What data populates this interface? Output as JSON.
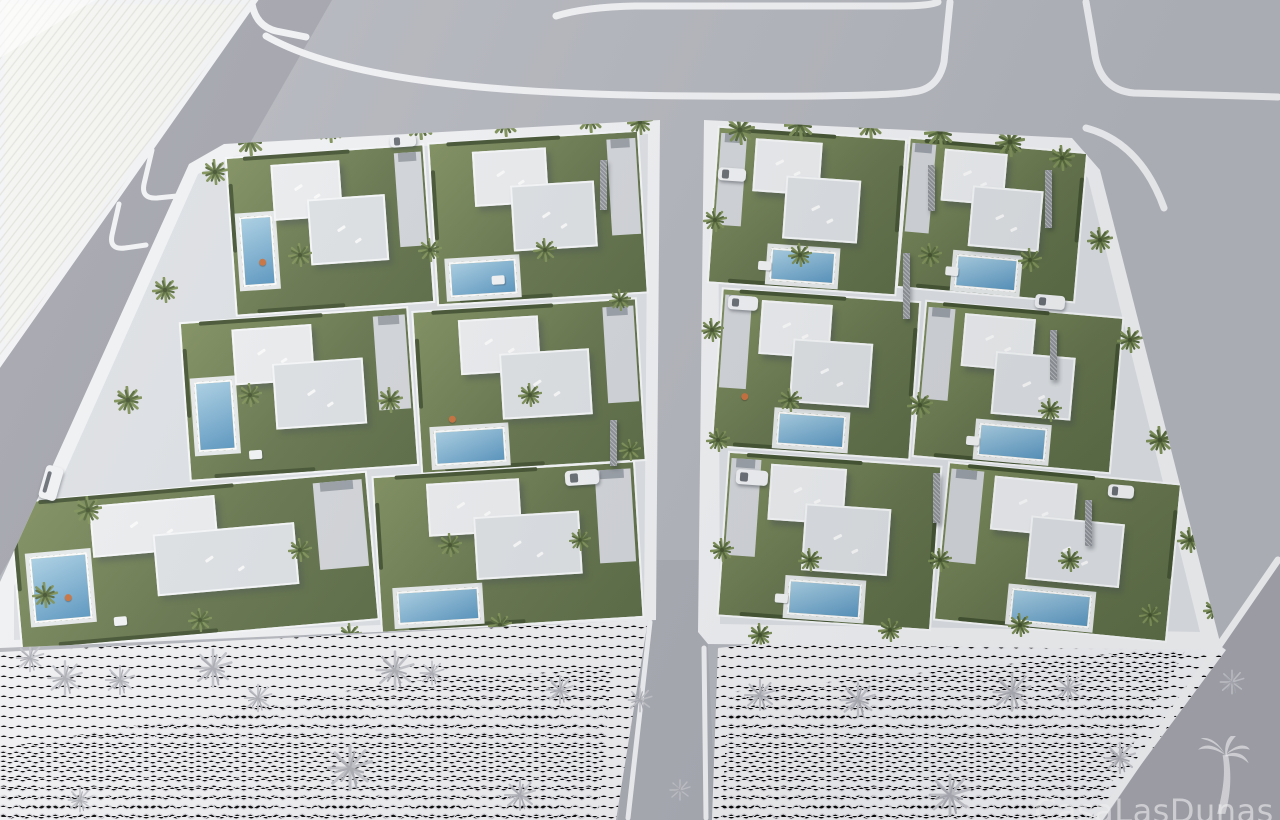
{
  "watermark": {
    "text": "CasaLasDunas",
    "icon": "palm-tree-icon"
  },
  "scene": {
    "type": "aerial-architectural-render",
    "blocks": 2,
    "villas": 12,
    "pools": 12
  },
  "colors": {
    "road": "#b5b7be",
    "road-shadow": "rgba(66,70,82,0.16)",
    "sidewalk": "#f3f4f6",
    "parcel": "#f5f5f2",
    "parcel-line": "#e2e2dd",
    "walk": "#dfe2e6",
    "drive": "#d4d7db",
    "wall": "#f8fafb",
    "roof-a": "#edeff1",
    "roof-b": "#dfe3e6",
    "grass": "#64744a",
    "grass-l": "#7e8e5c",
    "hedge": "#42512f",
    "pool-l": "#a9d0e5",
    "pool-d": "#5795c0",
    "deck": "#e9ecec",
    "tree": "#7d9055",
    "tree-d": "#55683a",
    "stone": "#8e9297",
    "car": "#f2f4f6",
    "car-glass": "#686d74",
    "sketch": "#f3f3f5",
    "sketch-line": "#c4c5cb",
    "watermark": "rgba(255,255,255,0.6)"
  }
}
